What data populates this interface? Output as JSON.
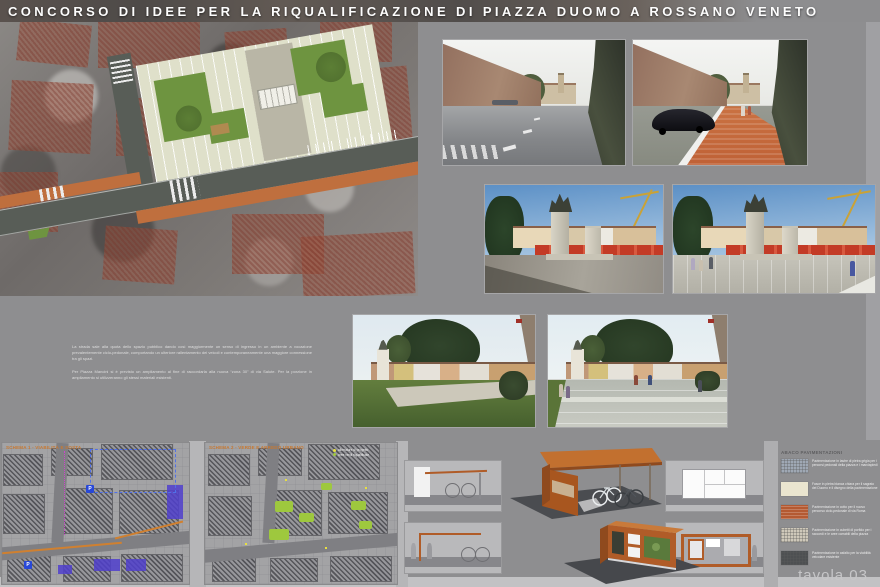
{
  "title": "CONCORSO DI IDEE PER LA RIQUALIFICAZIONE DI PIAZZA DUOMO A ROSSANO VENETO",
  "footer": {
    "tavola": "tavola 03"
  },
  "description": {
    "p1": "La strada sale alla quota dello spazio pubblico dando così maggiormente un senso di ingresso in un ambiente a vocazione prevalentemente ciclo-pedonale, comportando un ulteriore rallentamento dei veicoli e contemporaneamente una maggiore connessione tra gli spazi.",
    "p2": "Per Piazza Mancini si è previsto un ampliamento al fine di raccordarla alla nuova “zona 30” di via Salute. Per la porzione in ampliamento si utilizzeranno gli stessi materiali esistenti."
  },
  "maps": [
    {
      "caption": "SCHEMA 1 - VIABILITÀ E SOSTA",
      "p_marker": "P"
    },
    {
      "caption": "SCHEMA 2 - VERDE E ARREDO URBANO",
      "legend": [
        {
          "label": "alberature di progetto",
          "color": "#e8e040"
        },
        {
          "label": "aree verdi riqualificate",
          "color": "#9ec83e"
        }
      ]
    }
  ],
  "legend": {
    "title": "ABACO PAVIMENTAZIONI",
    "items": [
      {
        "color": "#9fa8b4",
        "label": "Pavimentazione in lastre di pietra grigia per i percorsi pedonali della piazza e i marciapiedi"
      },
      {
        "color": "#eae5cf",
        "label": "Fasce in pietra bianca chiara per il sagrato del Duomo e il disegno della pavimentazione"
      },
      {
        "color": "#b45a32",
        "label": "Pavimentazione in cotto per il nuovo percorso ciclo-pedonale di via Roma"
      },
      {
        "color": "#cec8ba",
        "label": "Pavimentazione in cubetti di porfido per i raccordi e le aree carrabili della piazza"
      },
      {
        "color": "#4e5052",
        "label": "Pavimentazione in asfalto per la viabilità veicolare esistente"
      }
    ]
  },
  "colors": {
    "corten": "#b05c28",
    "path_orange": "#c0703f",
    "plan_green": "#6f9441",
    "caption_orange": "#c87830"
  }
}
